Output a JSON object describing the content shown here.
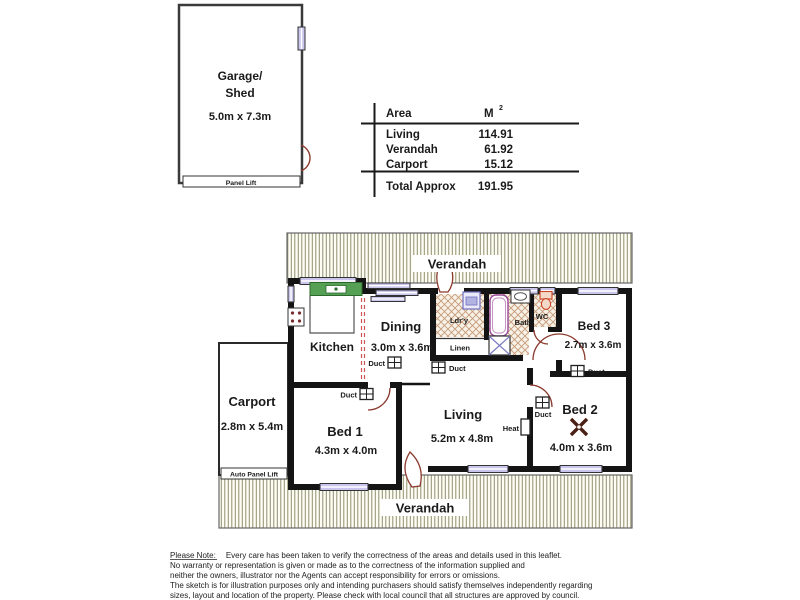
{
  "garage": {
    "name_line1": "Garage/",
    "name_line2": "Shed",
    "dims": "5.0m x 7.3m",
    "door_label": "Panel Lift"
  },
  "area_table": {
    "header": {
      "col1": "Area",
      "col2": "M",
      "col2_sup": "2"
    },
    "rows": [
      {
        "label": "Living",
        "value": "114.91"
      },
      {
        "label": "Verandah",
        "value": "61.92"
      },
      {
        "label": "Carport",
        "value": "15.12"
      }
    ],
    "total": {
      "label": "Total Approx",
      "value": "191.95"
    }
  },
  "floor_plan": {
    "verandah_top": "Verandah",
    "verandah_bottom": "Verandah",
    "carport": {
      "name": "Carport",
      "dims": "2.8m x 5.4m",
      "door_label": "Auto Panel Lift"
    },
    "rooms": {
      "kitchen": {
        "name": "Kitchen"
      },
      "dining": {
        "name": "Dining",
        "dims": "3.0m x 3.6m"
      },
      "living": {
        "name": "Living",
        "dims": "5.2m x 4.8m"
      },
      "bed1": {
        "name": "Bed 1",
        "dims": "4.3m x 4.0m"
      },
      "bed2": {
        "name": "Bed 2",
        "dims": "4.0m x 3.6m"
      },
      "bed3": {
        "name": "Bed 3",
        "dims": "2.7m x 3.6m"
      },
      "laundry": {
        "name": "Ldr'y"
      },
      "linen": {
        "name": "Linen"
      },
      "bath": {
        "name": "Bath"
      },
      "wc": {
        "name": "WC"
      }
    },
    "duct_label": "Duct",
    "heat_label": "Heat"
  },
  "disclaimer": {
    "prefix": "Please Note:",
    "line1_rest": "Every care has been taken to verify the correctness of the areas and details used in this leaflet.",
    "line2": "No warranty or representation is given or made as to the correctness of the information supplied and",
    "line3": "neither the owners, illustrator nor the Agents can accept responsibility for errors or omissions.",
    "line4": "The sketch is for illustration purposes only and intending purchasers should satisfy themselves independently regarding",
    "line5": "sizes, layout and location of the property. Please check with local council that all structures are approved by council."
  },
  "colors": {
    "wall": "#141414",
    "outline": "#3a3a3a",
    "verandah_stripe": "#8f8f72",
    "verandah_bg": "#fdfdf3",
    "wet_hatch": "#c59a7a",
    "wet_bg": "#f8f2e6",
    "door_arc": "#8b3a2e",
    "window_fill": "#c9c5ec",
    "sink_green": "#55a055",
    "dash_red": "#cc5555"
  }
}
